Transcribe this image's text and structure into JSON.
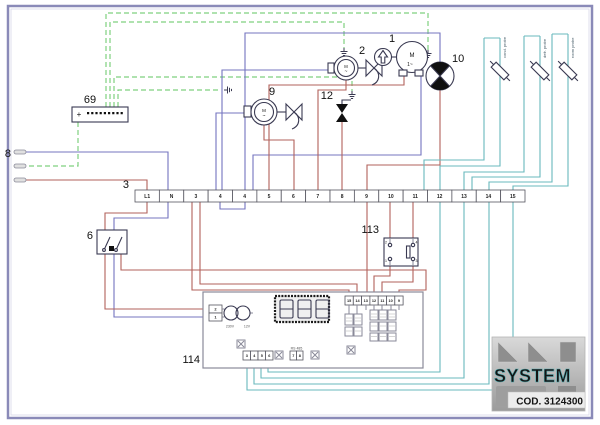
{
  "diagram": {
    "components": {
      "connector69": {
        "ref": "69",
        "polarity": "+"
      },
      "supply8": {
        "ref": "8"
      },
      "terminal_strip": {
        "ref": "3",
        "terminals": [
          "L1",
          "N",
          "3",
          "4",
          "4",
          "5",
          "6",
          "7",
          "8",
          "9",
          "10",
          "11",
          "12",
          "13",
          "14",
          "15"
        ]
      },
      "switch6": {
        "ref": "6"
      },
      "fan_motor9": {
        "ref": "9",
        "motor": "M",
        "phase": "~"
      },
      "fan_motor2": {
        "ref": "2",
        "motor": "M",
        "phase": "~"
      },
      "compressor1": {
        "ref": "1",
        "motor": "M",
        "phase": "1~"
      },
      "valve10": {
        "ref": "10"
      },
      "solenoid12": {
        "ref": "12"
      },
      "doorswitch113": {
        "ref": "113",
        "pins": [
          "2",
          "1",
          "4",
          "3"
        ]
      },
      "board114": {
        "ref": "114",
        "input_pins": [
          "2",
          "1"
        ],
        "transformer_primary": "230V",
        "transformer_secondary": "12V",
        "top_connector": [
          "15",
          "14",
          "13",
          "12",
          "11",
          "10",
          "9"
        ],
        "bottom_connector": [
          "3",
          "4",
          "5",
          "6"
        ],
        "rs485_label": "RS 485",
        "rs485_pins": [
          "7",
          "8"
        ]
      },
      "probes": [
        {
          "label": "cond. probe"
        },
        {
          "label": "defr. probe"
        },
        {
          "label": "room probe"
        }
      ]
    },
    "logo": {
      "brand": "SYSTEM",
      "code": "COD. 3124300"
    },
    "wire_colors": {
      "line": "#b2625b",
      "neutral": "#7474bf",
      "earth": "#7fd07f",
      "probe": "#68b9bd",
      "frame": "#8a8ab8"
    }
  }
}
